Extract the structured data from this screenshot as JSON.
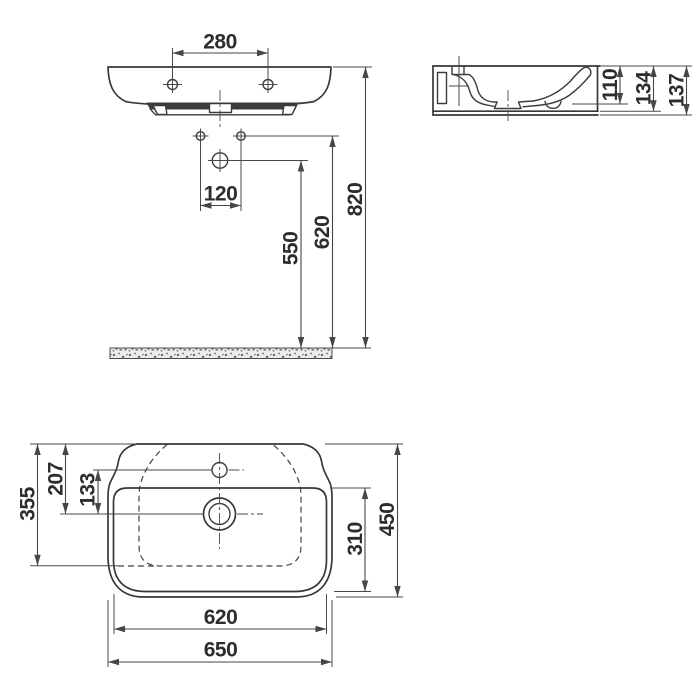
{
  "drawing": {
    "background": "#ffffff",
    "line_color": "#3c3c3c",
    "front_view": {
      "mounting_hole_spacing": "280",
      "tap_hole_spacing": "120",
      "drain_to_floor": "550",
      "holes_to_floor": "620",
      "rim_to_floor": "820"
    },
    "side_view": {
      "bowl_depth": "110",
      "edge_height": "134",
      "total_height": "137"
    },
    "plan_view": {
      "rear_to_bowl_front": "355",
      "rear_to_drain": "207",
      "tap_to_drain": "133",
      "bowl_inner_depth": "310",
      "total_depth": "450",
      "bowl_inner_width": "620",
      "total_width": "650"
    }
  }
}
